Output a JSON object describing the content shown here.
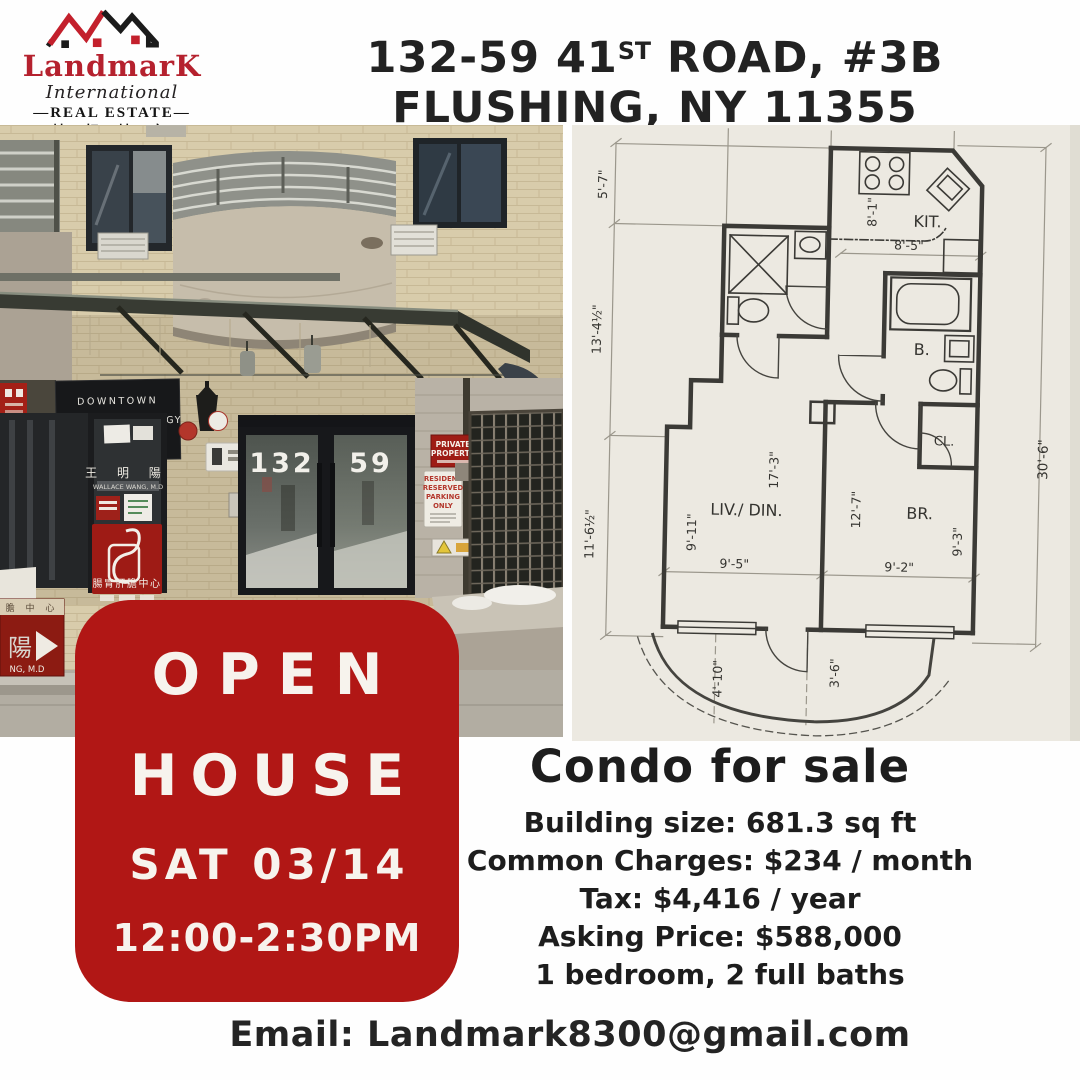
{
  "colors": {
    "accent_red": "#B11715",
    "logo_red": "#B5212E",
    "text_dark": "#1F1F1F"
  },
  "logo": {
    "brand": "LandmarK",
    "line2": "International",
    "line3": "—REAL ESTATE—",
    "line4": "地 标 地 产"
  },
  "address": {
    "l1a": "132-59 41",
    "l1sup": "ST",
    "l1b": " ROAD, #3B",
    "l2": "FLUSHING, NY 11355"
  },
  "photo": {
    "number_left": "132",
    "number_right": "59",
    "clinic_sign": [
      "DOWNTOWN",
      "GASTROENTEROLOGY",
      "& HEPATOLOGY"
    ],
    "private_sign": [
      "PRIVATE",
      "PROPERTY"
    ],
    "parking_sign": [
      "RESIDENT",
      "RESERVED",
      "PARKING",
      "ONLY"
    ],
    "doctor_cn": "王 明 陽",
    "doctor_en": "WALLACE WANG, M.D",
    "center_cn": "腸胃肝膽中心",
    "arrow_sign_top": "膽 中 心",
    "arrow_sign_char": "陽",
    "arrow_sign_sub": "NG, M.D"
  },
  "floorplan": {
    "rooms": {
      "kitchen": "KIT.",
      "bath": "B.",
      "closet": "CL.",
      "living": "LIV./ DIN.",
      "bedroom": "BR."
    },
    "dims": {
      "top_left": "5'-7\"",
      "left_mid": "13'-4½\"",
      "left_bottom": "11'-6½\"",
      "kit_depth": "8'-1\"",
      "kit_width": "8'-5\"",
      "right_side": "30'-6\"",
      "liv_len": "17'-3\"",
      "liv_depth": "9'-11\"",
      "liv_width": "9'-5\"",
      "br_len": "12'-7\"",
      "br_width": "9'-2\"",
      "br_depth": "9'-3\"",
      "balcony_a": "4'-10\"",
      "balcony_b": "3'-6\""
    }
  },
  "open_house": {
    "line1": "OPEN",
    "line2": "HOUSE",
    "line3": "SAT 03/14",
    "line4": "12:00-2:30PM"
  },
  "listing": {
    "title": "Condo for sale",
    "details": [
      "Building size: 681.3 sq ft",
      "Common Charges: $234 / month",
      "Tax: $4,416 / year",
      "Asking Price: $588,000",
      "1 bedroom, 2 full baths"
    ]
  },
  "footer": {
    "email": "Email: Landmark8300@gmail.com"
  }
}
